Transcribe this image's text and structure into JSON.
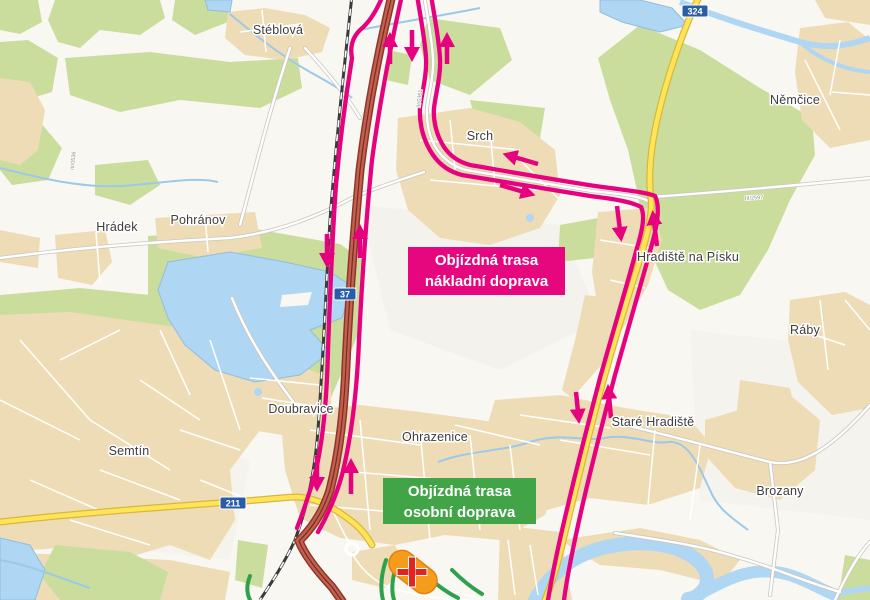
{
  "map": {
    "towns": [
      {
        "name": "Stéblová"
      },
      {
        "name": "Hrádek"
      },
      {
        "name": "Pohránov"
      },
      {
        "name": "Srch"
      },
      {
        "name": "Němčice"
      },
      {
        "name": "Hradiště na Písku"
      },
      {
        "name": "Ráby"
      },
      {
        "name": "Doubravice"
      },
      {
        "name": "Ohrazenice"
      },
      {
        "name": "Semtín"
      },
      {
        "name": "Staré Hradiště"
      },
      {
        "name": "Brozany"
      }
    ],
    "road_shields": [
      {
        "number": "37"
      },
      {
        "number": "324"
      },
      {
        "number": "211"
      }
    ],
    "road_refs": [
      {
        "text": "III/0361"
      },
      {
        "text": "III/2597"
      },
      {
        "text": "III/0536"
      }
    ],
    "annotations": {
      "freight": {
        "line1": "Objízdná trasa",
        "line2": "nákladní doprava",
        "color": "#e6077f"
      },
      "passenger": {
        "line1": "Objízdná trasa",
        "line2": "osobní doprava",
        "color": "#41a447"
      }
    },
    "colors": {
      "detour_route_pink": "#e6017e",
      "passenger_route_green": "#2ea14d",
      "highway_fill": "#c2604f",
      "highway_casing": "#8e362c",
      "main_road_yellow": "#ffe45a",
      "water": "#afd6f2",
      "forest": "#cbdd9d",
      "urban": "#eedcb6",
      "railway": "#3a3a3a",
      "closure_orange": "#f59c1c",
      "closure_cross_red": "#e02424",
      "shield_blue": "#2a5da8"
    },
    "icons": {
      "road_closure": "+",
      "direction_arrow": "↑"
    }
  }
}
